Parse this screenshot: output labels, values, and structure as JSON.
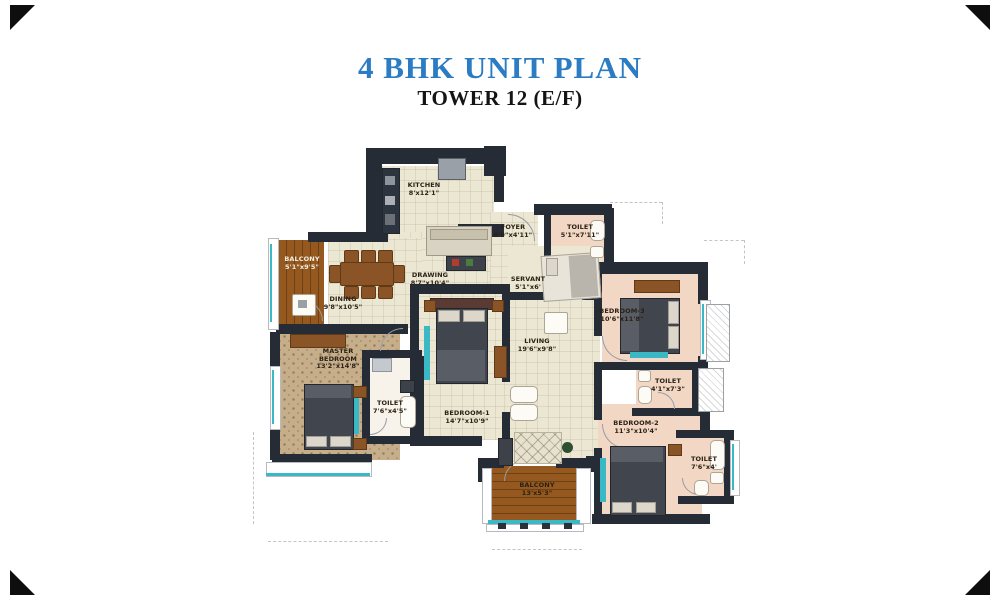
{
  "header": {
    "title": "4 BHK UNIT PLAN",
    "subtitle": "TOWER 12 (E/F)"
  },
  "colors": {
    "title_blue": "#2b7cc3",
    "subtitle_black": "#141414",
    "wall_dark": "#262c36",
    "floor_cream": "#ece7d3",
    "floor_pink": "#f1d7c4",
    "floor_master_pattern": "#c6ae8b",
    "balcony_wood": "#95591f",
    "window_teal": "#3ab8c6"
  },
  "rooms": [
    {
      "id": "kitchen",
      "name": "KITCHEN",
      "dims": "8'x12'1\""
    },
    {
      "id": "foyer",
      "name": "FOYER",
      "dims": "8'9\"x4'11\""
    },
    {
      "id": "toilet-entry",
      "name": "TOILET",
      "dims": "5'1\"x7'11\""
    },
    {
      "id": "servant",
      "name": "SERVANT",
      "dims": "5'1\"x6'"
    },
    {
      "id": "drawing",
      "name": "DRAWING",
      "dims": "8'7\"x10'4\""
    },
    {
      "id": "dining",
      "name": "DINING",
      "dims": "9'8\"x10'5\""
    },
    {
      "id": "balcony-left",
      "name": "BALCONY",
      "dims": "5'1\"x9'5\""
    },
    {
      "id": "master-bedroom",
      "name": "MASTER BEDROOM",
      "dims": "13'2\"x14'8\""
    },
    {
      "id": "toilet-master",
      "name": "TOILET",
      "dims": "7'6\"x4'5\""
    },
    {
      "id": "bedroom-1",
      "name": "BEDROOM-1",
      "dims": "14'7\"x10'9\""
    },
    {
      "id": "living",
      "name": "LIVING",
      "dims": "19'6\"x9'8\""
    },
    {
      "id": "bedroom-3",
      "name": "BEDROOM-3",
      "dims": "10'6\"x11'8\""
    },
    {
      "id": "toilet-bed3",
      "name": "TOILET",
      "dims": "4'1\"x7'3\""
    },
    {
      "id": "bedroom-2",
      "name": "BEDROOM-2",
      "dims": "11'3\"x10'4\""
    },
    {
      "id": "toilet-bed2",
      "name": "TOILET",
      "dims": "7'6\"x4'"
    },
    {
      "id": "balcony-bottom",
      "name": "BALCONY",
      "dims": "13'x5'3\""
    }
  ]
}
